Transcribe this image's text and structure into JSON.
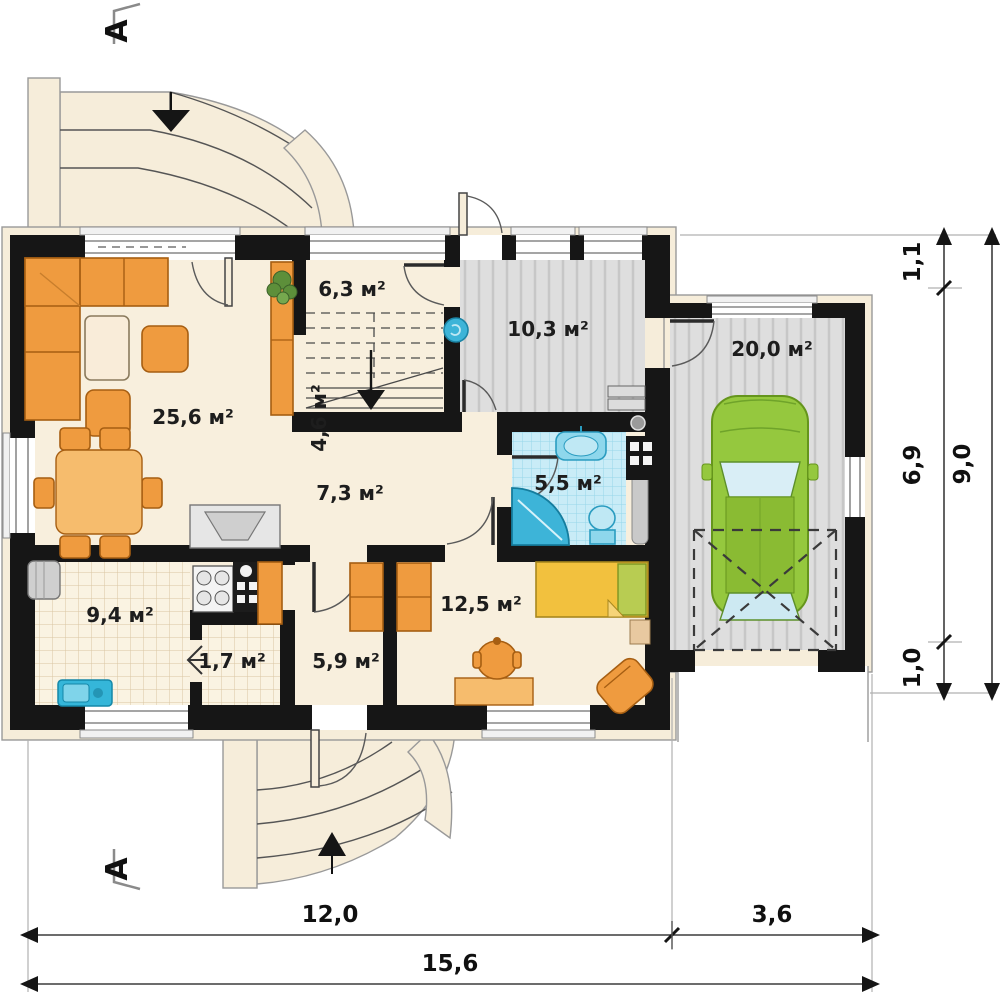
{
  "title": "House ground floor plan",
  "section": {
    "letter": "A"
  },
  "rooms": {
    "living": "25,6 м²",
    "entry": "6,3 м²",
    "stairs": "4,6 м²",
    "utility": "10,3 м²",
    "hallway": "7,3 м²",
    "bathroom": "5,5 м²",
    "garage": "20,0 м²",
    "kitchen": "9,4 м²",
    "pantry": "1,7 м²",
    "corridor": "5,9 м²",
    "bedroom": "12,5 м²"
  },
  "dimensions": {
    "right_top": "1,1",
    "right_mid": "6,9",
    "right_bottom": "1,0",
    "right_total": "9,0",
    "bottom_left": "12,0",
    "bottom_right": "3,6",
    "bottom_total": "15,6"
  },
  "colors": {
    "wall": "#161616",
    "floor_cream": "#f8efdd",
    "floor_gray": "#dedede",
    "bath_tile": "#c9ecf7",
    "furniture_orange": "#ef9b3f",
    "car_green": "#95c83e",
    "bed_yellow": "#f2c13e",
    "fixture_blue": "#3db4d8"
  }
}
